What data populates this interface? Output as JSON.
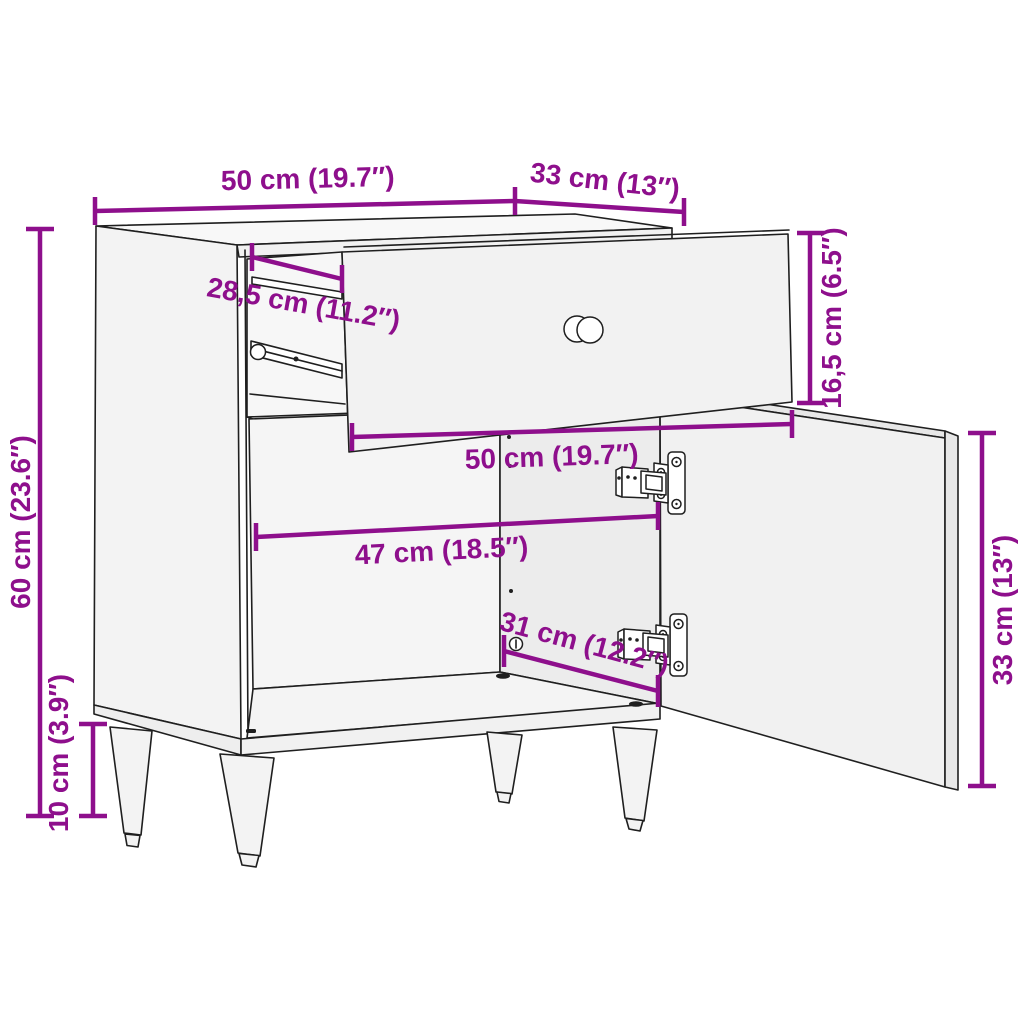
{
  "diagram": {
    "type": "furniture-dimension-drawing",
    "subject": "bedside cabinet with open drawer and open door",
    "colors": {
      "dimension_accent": "#8E0F8C",
      "outline": "#1f1f1f",
      "panel_fill": "#f3f3f3",
      "background": "#ffffff"
    },
    "dims": {
      "top_width": "50 cm (19.7″)",
      "top_depth": "33 cm (13″)",
      "slide_depth": "28,5 cm (11.2″)",
      "drawer_height": "16,5 cm (6.5″)",
      "drawer_width": "50 cm (19.7″)",
      "interior_width": "47 cm (18.5″)",
      "interior_depth": "31 cm (12.2″)",
      "door_height": "33 cm (13″)",
      "total_height": "60 cm (23.6″)",
      "leg_height": "10 cm (3.9″)"
    }
  }
}
